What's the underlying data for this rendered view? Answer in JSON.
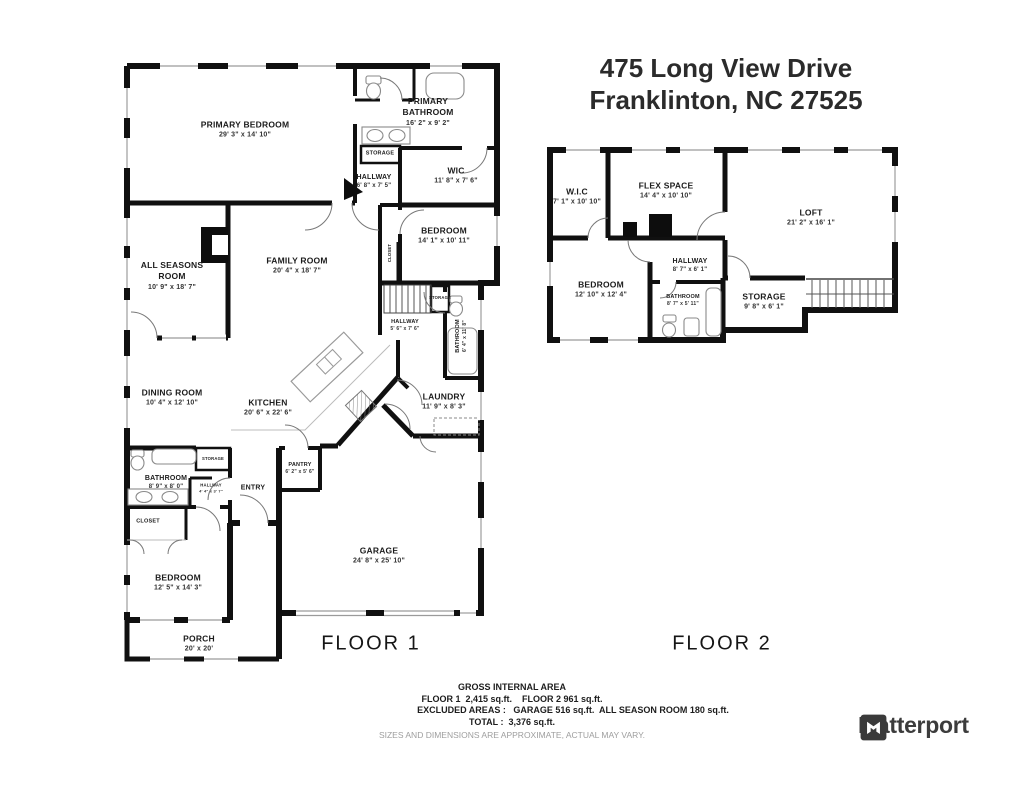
{
  "title": {
    "line1": "475 Long View Drive",
    "line2": "Franklinton, NC 27525"
  },
  "floor1": {
    "caption": "FLOOR 1",
    "labels": [
      {
        "name": "PRIMARY BEDROOM",
        "dims": "29' 3\" x 14' 10\"",
        "x": 245,
        "y": 130
      },
      {
        "name": "PRIMARY\nBATHROOM",
        "dims": "16' 2\" x 9' 2\"",
        "x": 428,
        "y": 112
      },
      {
        "name": "STORAGE",
        "x": 380,
        "y": 154,
        "size": "xs"
      },
      {
        "name": "HALLWAY",
        "dims": "6' 8\" x 7' 5\"",
        "x": 374,
        "y": 182,
        "size": "s"
      },
      {
        "name": "WIC",
        "dims": "11' 8\" x 7' 6\"",
        "x": 456,
        "y": 176
      },
      {
        "name": "BEDROOM",
        "dims": "14' 1\" x 10' 11\"",
        "x": 444,
        "y": 236
      },
      {
        "name": "CLOSET",
        "x": 390,
        "y": 253,
        "size": "xxs",
        "vertical": true
      },
      {
        "name": "ALL SEASONS\nROOM",
        "dims": "10' 9\" x 18' 7\"",
        "x": 172,
        "y": 276
      },
      {
        "name": "FAMILY ROOM",
        "dims": "20' 4\" x 18' 7\"",
        "x": 297,
        "y": 266
      },
      {
        "name": "STORAGE",
        "x": 440,
        "y": 298,
        "size": "xxs"
      },
      {
        "name": "HALLWAY",
        "dims": "5' 6\" x 7' 6\"",
        "x": 405,
        "y": 326,
        "size": "xs"
      },
      {
        "name": "BATHROOM",
        "dims": "6' 4\" x 11' 8\"",
        "x": 462,
        "y": 336,
        "size": "xs",
        "vertical": true
      },
      {
        "name": "DINING ROOM",
        "dims": "10' 4\" x 12' 10\"",
        "x": 172,
        "y": 398
      },
      {
        "name": "KITCHEN",
        "dims": "20' 6\" x 22' 6\"",
        "x": 268,
        "y": 408
      },
      {
        "name": "LAUNDRY",
        "dims": "11' 9\" x 8' 3\"",
        "x": 444,
        "y": 402
      },
      {
        "name": "STORAGE",
        "x": 213,
        "y": 459,
        "size": "xxs"
      },
      {
        "name": "BATHROOM",
        "dims": "8' 9\" x 8' 0\"",
        "x": 166,
        "y": 483,
        "size": "s"
      },
      {
        "name": "HALLWAY",
        "dims": "4' 4\" x 3' 7\"",
        "x": 211,
        "y": 488,
        "size": "xxs"
      },
      {
        "name": "ENTRY",
        "x": 253,
        "y": 488,
        "size": "s"
      },
      {
        "name": "PANTRY",
        "dims": "6' 2\" x 5' 6\"",
        "x": 300,
        "y": 469,
        "size": "xs"
      },
      {
        "name": "CLOSET",
        "x": 148,
        "y": 522,
        "size": "xs"
      },
      {
        "name": "BEDROOM",
        "dims": "12' 5\" x 14' 3\"",
        "x": 178,
        "y": 583
      },
      {
        "name": "GARAGE",
        "dims": "24' 8\" x 25' 10\"",
        "x": 379,
        "y": 556
      },
      {
        "name": "PORCH",
        "dims": "20' x 20'",
        "x": 199,
        "y": 644
      }
    ]
  },
  "floor2": {
    "caption": "FLOOR 2",
    "labels": [
      {
        "name": "W.I.C",
        "dims": "7' 1\" x 10' 10\"",
        "x": 577,
        "y": 197
      },
      {
        "name": "FLEX SPACE",
        "dims": "14' 4\" x 10' 10\"",
        "x": 666,
        "y": 191
      },
      {
        "name": "LOFT",
        "dims": "21' 2\" x 16' 1\"",
        "x": 811,
        "y": 218
      },
      {
        "name": "BEDROOM",
        "dims": "12' 10\" x 12' 4\"",
        "x": 601,
        "y": 290
      },
      {
        "name": "HALLWAY",
        "dims": "8' 7\" x 6' 1\"",
        "x": 690,
        "y": 266,
        "size": "s"
      },
      {
        "name": "BATHROOM",
        "dims": "8' 7\" x 5' 11\"",
        "x": 683,
        "y": 301,
        "size": "xs"
      },
      {
        "name": "STORAGE",
        "dims": "9' 8\" x 6' 1\"",
        "x": 764,
        "y": 302
      }
    ]
  },
  "summary": {
    "gross": "GROSS INTERNAL AREA",
    "floors": "FLOOR 1  2,415 sq.ft.    FLOOR 2 961 sq.ft.",
    "excluded": "EXCLUDED AREAS :   GARAGE 516 sq.ft.  ALL SEASON ROOM 180 sq.ft.",
    "total": "TOTAL :  3,376 sq.ft.",
    "disclaimer": "SIZES AND DIMENSIONS ARE APPROXIMATE, ACTUAL MAY VARY."
  },
  "branding": {
    "name": "Matterport"
  },
  "colors": {
    "walls": "#101010",
    "room_text": "#1c1c1c",
    "muted_text": "#9e9e9e",
    "logo": "#3c3c3c",
    "background": "#ffffff"
  }
}
